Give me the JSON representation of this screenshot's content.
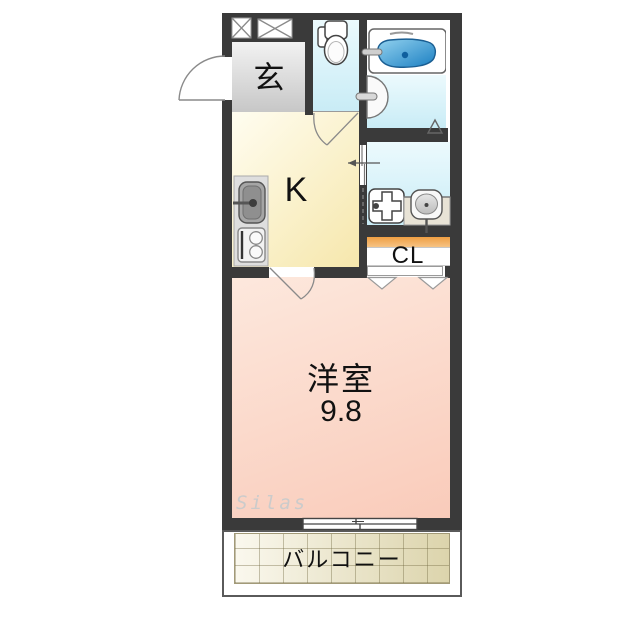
{
  "plan": {
    "kind": "japanese-1k-floorplan",
    "watermark": "Silas",
    "rooms": {
      "entrance": {
        "label": "玄"
      },
      "kitchen": {
        "label": "K"
      },
      "closet": {
        "label": "CL"
      },
      "western_room": {
        "label": "洋室",
        "size": "9.8"
      },
      "balcony": {
        "label": "バルコニー"
      }
    },
    "icons": {
      "meter_box": "white box with X cross (x2, in top wall)",
      "toilet": "tank + bowl, toilet room",
      "bathtub": "blue tub in white panel",
      "bath_door": "half-circle swing on bath wall",
      "washing_machine_pan": "square with plus cross and drain dot",
      "washbasin": "rounded basin on counter with faucet stem",
      "kitchen_sink": "gray sink with faucet",
      "stove": "two burner circles",
      "entrance_door": "quarter-arc swing, opens outward",
      "sliding_window": "double-sash window to balcony",
      "folding_closet_door": "double chevron"
    }
  },
  "colors": {
    "wall": "#3a3a3a",
    "line": "#888888",
    "genkan1": "#f2f2f2",
    "genkan2": "#c7c7c7",
    "kitchen1": "#fffdf0",
    "kitchen2": "#f6e7ac",
    "wet1": "#ecfafd",
    "wet2": "#c9ecf6",
    "tub1": "#93d2ef",
    "tub2": "#1b7fc2",
    "closet1": "#fbd9ab",
    "closet2": "#ef9f43",
    "room1": "#fde8dd",
    "room2": "#f9cbba",
    "balc1": "#faf8ee",
    "balc2": "#dcd4ac",
    "wm": "#cbcbcb"
  }
}
